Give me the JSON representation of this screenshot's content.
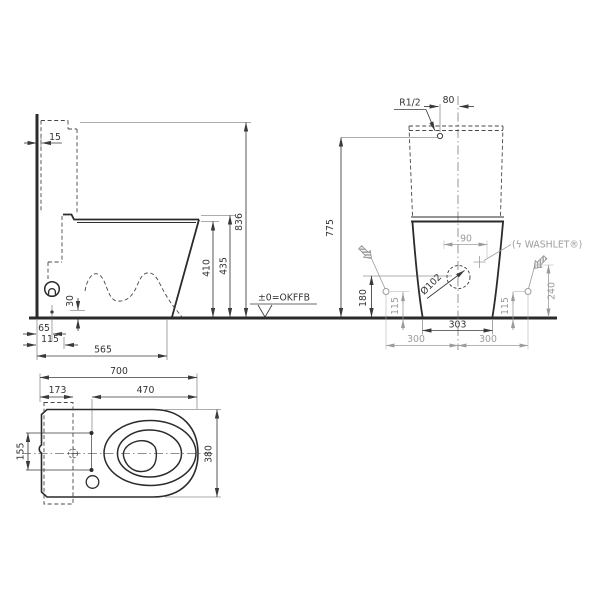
{
  "drawing": {
    "type": "toilet-technical-dimension-drawing",
    "colors": {
      "line": "#2b2b2b",
      "dim": "#3a3a3a",
      "gray": "#9b9b9b",
      "background": "#ffffff"
    },
    "side_view": {
      "dims": {
        "d15": "15",
        "d836": "836",
        "d435": "435",
        "d410": "410",
        "d30": "30",
        "d65": "65",
        "d115": "115",
        "d565": "565"
      },
      "floor_label": "±0=OKFFB"
    },
    "rear_view": {
      "dims": {
        "r12": "R1/2",
        "d80": "80",
        "d775": "775",
        "d90": "90",
        "d102": "Ø102",
        "d180": "180",
        "d115l": "115",
        "d115r": "115",
        "d240": "240",
        "d303": "303",
        "d300l": "300",
        "d300r": "300"
      },
      "washlet_label": "(ϟ WASHLET®)"
    },
    "plan_view": {
      "dims": {
        "d700": "700",
        "d173": "173",
        "d470": "470",
        "d155": "155",
        "d380": "380"
      }
    }
  }
}
